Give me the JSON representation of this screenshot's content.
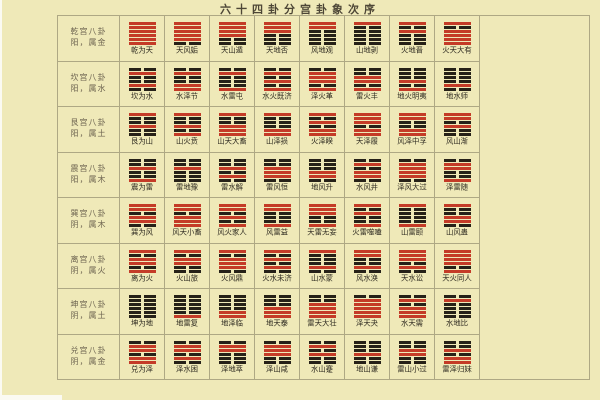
{
  "title": "六十四卦分宫卦象次序",
  "colors": {
    "background": "#efe9b8",
    "grid_line": "#aea884",
    "yang_line": "#c43b27",
    "yin_line": "#262118",
    "title_text": "#4d4636",
    "label_text": "#6d6450",
    "name_text": "#2e2a20"
  },
  "line_encoding": "lines listed top-to-bottom; 1 = yang solid red bar, 0 = yin broken black bar",
  "palaces": [
    {
      "name": "乾宫八卦",
      "attribute": "阳，属金",
      "hexagrams": [
        {
          "name": "乾为天",
          "lines": "111111"
        },
        {
          "name": "天风姤",
          "lines": "111110"
        },
        {
          "name": "天山遁",
          "lines": "111100"
        },
        {
          "name": "天地否",
          "lines": "111000"
        },
        {
          "name": "风地观",
          "lines": "110000"
        },
        {
          "name": "山地剥",
          "lines": "100000"
        },
        {
          "name": "火地晋",
          "lines": "101000"
        },
        {
          "name": "火天大有",
          "lines": "101111"
        }
      ]
    },
    {
      "name": "坎宫八卦",
      "attribute": "阳，属水",
      "hexagrams": [
        {
          "name": "坎为水",
          "lines": "010010"
        },
        {
          "name": "水泽节",
          "lines": "010011"
        },
        {
          "name": "水雷屯",
          "lines": "010001"
        },
        {
          "name": "水火既济",
          "lines": "010101"
        },
        {
          "name": "泽火革",
          "lines": "011101"
        },
        {
          "name": "雷火丰",
          "lines": "001101"
        },
        {
          "name": "地火明夷",
          "lines": "000101"
        },
        {
          "name": "地水师",
          "lines": "000010"
        }
      ]
    },
    {
      "name": "艮宫八卦",
      "attribute": "阳，属土",
      "hexagrams": [
        {
          "name": "艮为山",
          "lines": "100100"
        },
        {
          "name": "山火贲",
          "lines": "100101"
        },
        {
          "name": "山天大畜",
          "lines": "100111"
        },
        {
          "name": "山泽损",
          "lines": "100011"
        },
        {
          "name": "火泽睽",
          "lines": "101011"
        },
        {
          "name": "天泽履",
          "lines": "111011"
        },
        {
          "name": "风泽中孚",
          "lines": "110011"
        },
        {
          "name": "风山渐",
          "lines": "110100"
        }
      ]
    },
    {
      "name": "震宫八卦",
      "attribute": "阳，属木",
      "hexagrams": [
        {
          "name": "震为雷",
          "lines": "001001"
        },
        {
          "name": "雷地豫",
          "lines": "001000"
        },
        {
          "name": "雷水解",
          "lines": "001010"
        },
        {
          "name": "雷风恒",
          "lines": "001110"
        },
        {
          "name": "地风升",
          "lines": "000110"
        },
        {
          "name": "水风井",
          "lines": "010110"
        },
        {
          "name": "泽风大过",
          "lines": "011110"
        },
        {
          "name": "泽雷随",
          "lines": "011001"
        }
      ]
    },
    {
      "name": "巽宫八卦",
      "attribute": "阴，属木",
      "hexagrams": [
        {
          "name": "巽为风",
          "lines": "110110"
        },
        {
          "name": "风天小畜",
          "lines": "110111"
        },
        {
          "name": "风火家人",
          "lines": "110101"
        },
        {
          "name": "风雷益",
          "lines": "110001"
        },
        {
          "name": "天雷无妄",
          "lines": "111001"
        },
        {
          "name": "火雷噬嗑",
          "lines": "101001"
        },
        {
          "name": "山雷颐",
          "lines": "100001"
        },
        {
          "name": "山风蛊",
          "lines": "100110"
        }
      ]
    },
    {
      "name": "离宫八卦",
      "attribute": "阴，属火",
      "hexagrams": [
        {
          "name": "离为火",
          "lines": "101101"
        },
        {
          "name": "火山旅",
          "lines": "101100"
        },
        {
          "name": "火风鼎",
          "lines": "101110"
        },
        {
          "name": "火水未济",
          "lines": "101010"
        },
        {
          "name": "山水蒙",
          "lines": "100010"
        },
        {
          "name": "风水涣",
          "lines": "110010"
        },
        {
          "name": "天水讼",
          "lines": "111010"
        },
        {
          "name": "天火同人",
          "lines": "111101"
        }
      ]
    },
    {
      "name": "坤宫八卦",
      "attribute": "阴，属土",
      "hexagrams": [
        {
          "name": "坤为地",
          "lines": "000000"
        },
        {
          "name": "地雷复",
          "lines": "000001"
        },
        {
          "name": "地泽临",
          "lines": "000011"
        },
        {
          "name": "地天泰",
          "lines": "000111"
        },
        {
          "name": "雷天大壮",
          "lines": "001111"
        },
        {
          "name": "泽天夬",
          "lines": "011111"
        },
        {
          "name": "水天需",
          "lines": "010111"
        },
        {
          "name": "水地比",
          "lines": "010000"
        }
      ]
    },
    {
      "name": "兑宫八卦",
      "attribute": "阴，属金",
      "hexagrams": [
        {
          "name": "兑为泽",
          "lines": "011011"
        },
        {
          "name": "泽水困",
          "lines": "011010"
        },
        {
          "name": "泽地萃",
          "lines": "011000"
        },
        {
          "name": "泽山咸",
          "lines": "011100"
        },
        {
          "name": "水山蹇",
          "lines": "010100"
        },
        {
          "name": "地山谦",
          "lines": "000100"
        },
        {
          "name": "雷山小过",
          "lines": "001100"
        },
        {
          "name": "雷泽归妹",
          "lines": "001011"
        }
      ]
    }
  ]
}
